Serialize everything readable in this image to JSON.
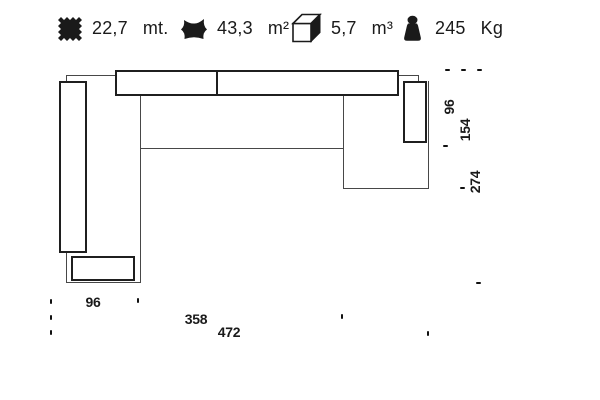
{
  "header": {
    "items": [
      {
        "icon": "fabric-meters-icon",
        "value": "22,7",
        "unit": "mt."
      },
      {
        "icon": "leather-area-icon",
        "value": "43,3",
        "unit": "m²"
      },
      {
        "icon": "volume-cube-icon",
        "value": "5,7",
        "unit": "m³"
      },
      {
        "icon": "weight-icon",
        "value": "245",
        "unit": "Kg"
      }
    ]
  },
  "diagram": {
    "type": "sofa-top-view-plan",
    "right_dims": [
      "96",
      "154",
      "274"
    ],
    "bottom_dims": [
      "96",
      "358",
      "472"
    ]
  },
  "colors": {
    "ink": "#1a1a1a",
    "thin_line": "#474747",
    "bold_line": "#1f1f1f",
    "background": "#ffffff"
  }
}
